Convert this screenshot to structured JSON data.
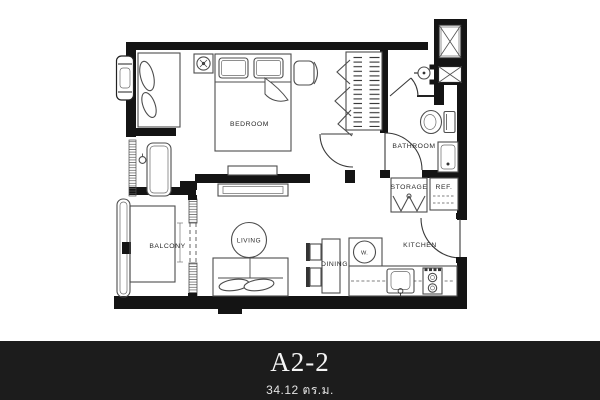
{
  "plan": {
    "title": "Unit floor plan",
    "labels": {
      "bedroom": "BEDROOM",
      "bathroom": "BATHROOM",
      "storage": "STORAGE",
      "ref": "REF.",
      "kitchen": "KITCHEN",
      "dining": "DINING",
      "living": "LIVING",
      "washer": "W.",
      "balcony": "BALCONY"
    }
  },
  "footer": {
    "unit_name": "A2-2",
    "area": "34.12 ตร.ม."
  },
  "colors": {
    "wall": "#141414",
    "furniture_line": "#4d4d4d",
    "label_text": "#2a2a2a",
    "footer_bg": "#1c1c1c",
    "footer_text": "#f5f5f5"
  }
}
